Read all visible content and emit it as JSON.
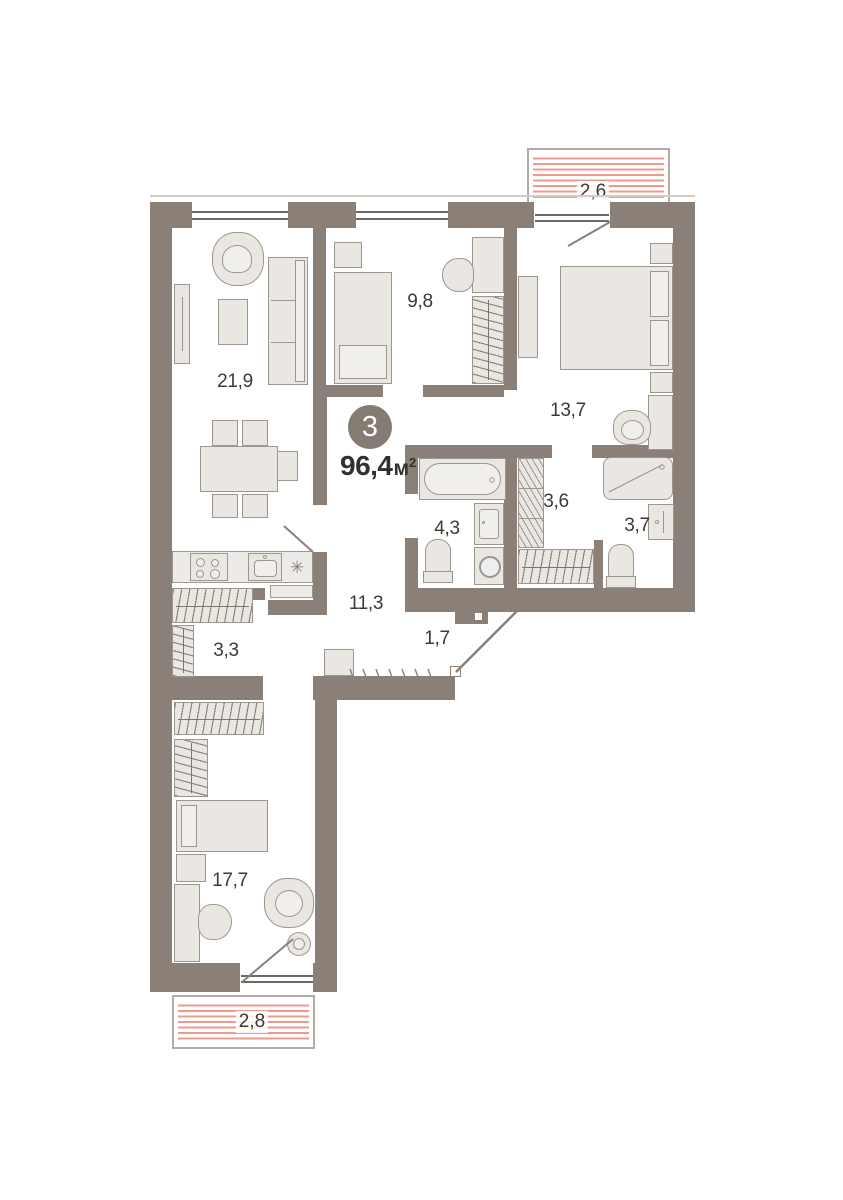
{
  "floorplan": {
    "badge": {
      "rooms_count": "3",
      "area_value": "96,4",
      "area_unit": "м",
      "area_sup": "2"
    },
    "rooms": [
      {
        "id": "living",
        "label": "21,9"
      },
      {
        "id": "bedroom-small",
        "label": "9,8"
      },
      {
        "id": "bedroom-master",
        "label": "13,7"
      },
      {
        "id": "bathroom",
        "label": "4,3"
      },
      {
        "id": "walkin-closet",
        "label": "3,6"
      },
      {
        "id": "shower-room",
        "label": "3,7"
      },
      {
        "id": "hallway",
        "label": "11,3"
      },
      {
        "id": "entry",
        "label": "1,7"
      },
      {
        "id": "storage",
        "label": "3,3"
      },
      {
        "id": "bedroom-bottom",
        "label": "17,7"
      }
    ],
    "balconies": [
      {
        "id": "balcony-top",
        "label": "2,6"
      },
      {
        "id": "balcony-bottom",
        "label": "2,8"
      }
    ],
    "kitchen": {
      "fridge_symbol": "✳"
    },
    "colors": {
      "wall": "#8a8078",
      "furniture_fill": "#eae7e3",
      "furniture_stroke": "#9d968e",
      "label_text": "#3d3a35",
      "balcony_stripe": "#ef9a8c",
      "badge_bg": "#847c72"
    }
  }
}
